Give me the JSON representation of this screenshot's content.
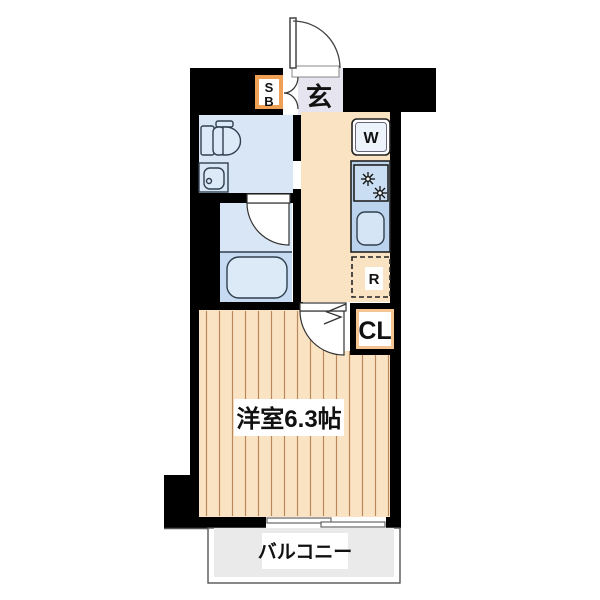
{
  "plan": {
    "labels": {
      "entrance": "玄",
      "shoe_box": [
        "S",
        "B"
      ],
      "washer": "W",
      "refrigerator": "R",
      "closet": "CL",
      "main_room": "洋室6.3帖",
      "balcony": "バルコニー"
    },
    "colors": {
      "wall": "#000000",
      "wood_floor": "#FAE3C2",
      "floor_stripe": "#B9885C",
      "entrance_floor": "#E6E5EF",
      "wet_room": "#D8E6F5",
      "bath_tub_area": "#C6DAF1",
      "fixture": "#DCE9F7",
      "kitchen_counter": "#BCD3EE",
      "stove_panel": "#C9DDF3",
      "sink": "#D5E5F6",
      "accent_orange": "#F0A055",
      "closet_frame": "#F5C493",
      "balcony_floor": "#EAEAEA",
      "outline": "#333333"
    }
  }
}
